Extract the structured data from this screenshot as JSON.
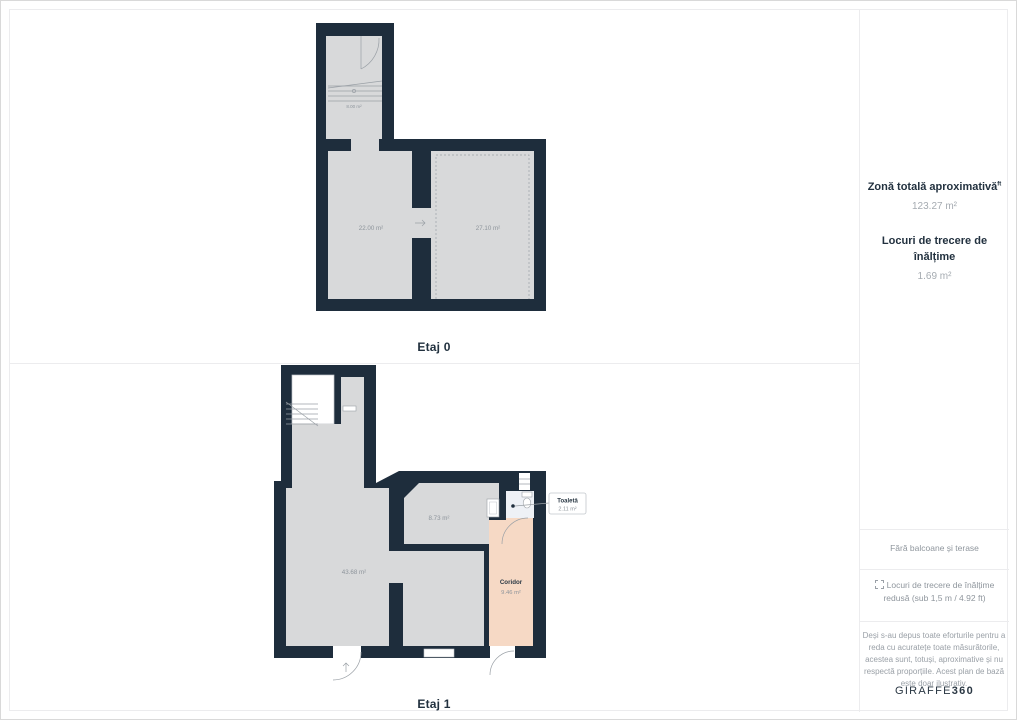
{
  "floors": {
    "etaj0": {
      "label": "Etaj 0",
      "stairs_area": "8.00 m²",
      "room_left_area": "22.00 m²",
      "room_right_area": "27.10 m²"
    },
    "etaj1": {
      "label": "Etaj 1",
      "living_area": "43.68 m²",
      "mid_room_area": "8.73 m²",
      "toilet": {
        "name": "Toaletă",
        "area": "2.11 m²"
      },
      "corridor": {
        "name": "Coridor",
        "area": "9.46 m²"
      }
    }
  },
  "sidebar": {
    "total_area": {
      "label": "Zonă totală aproximativă",
      "superscript": "ft",
      "value": "123.27 m²"
    },
    "headroom": {
      "label": "Locuri de trecere de înălțime",
      "value": "1.69 m²"
    },
    "note_balconies": "Fără balcoane și terase",
    "note_reduced_line1": "Locuri de trecere de înălțime",
    "note_reduced_line2": "redusă (sub 1,5 m / 4.92 ft)",
    "disclaimer": "Deși s-au depus toate eforturile pentru a reda cu acuratețe toate măsurătorile, acestea sunt, totuși, aproximative și nu respectă proporțiile. Acest plan de bază este doar ilustrativ.",
    "brand": {
      "prefix": "GIRAFFE",
      "suffix": "360"
    }
  },
  "colors": {
    "wall": "#1e2d3c",
    "floor": "#d8d9da",
    "corridor": "#f6d9c5",
    "toilet": "#eef1f6"
  }
}
